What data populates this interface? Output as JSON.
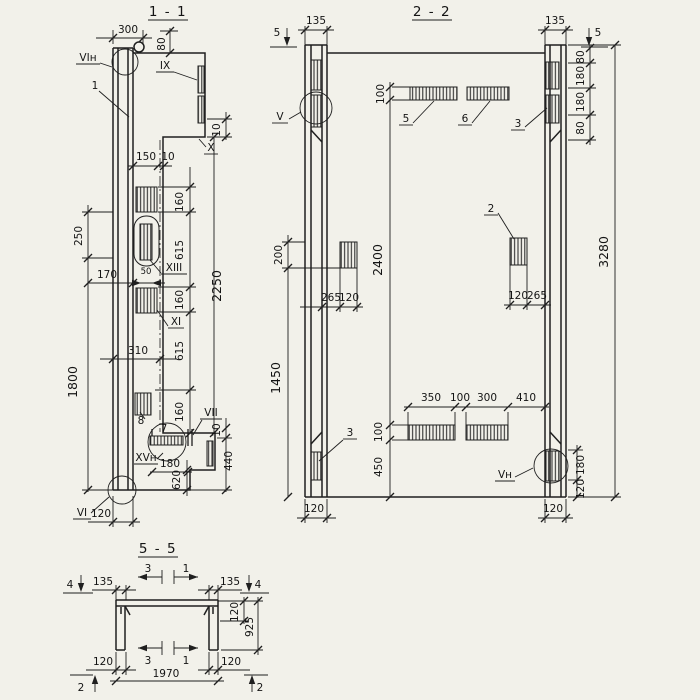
{
  "meta": {
    "paper_color": "#f2f1ea",
    "ink_color": "#1f1f1f",
    "drawing_type": "reinforced concrete element sections"
  },
  "s11": {
    "title": "1 - 1",
    "dim_300": "300",
    "dim_80": "80",
    "dim_10_top": "10",
    "dim_150": "150",
    "dim_10_web": "10",
    "dim_160_1": "160",
    "dim_615_1": "615",
    "dim_160_2": "160",
    "dim_615_2": "615",
    "dim_160_3": "160",
    "dim_2250": "2250",
    "dim_250": "250",
    "dim_170": "170",
    "dim_50": "50",
    "dim_310": "310",
    "dim_1800": "1800",
    "dim_10_bot": "10",
    "dim_440": "440",
    "dim_180": "180",
    "dim_620": "620",
    "dim_120": "120",
    "lbl_vi_n": "VIн",
    "lbl_1": "1",
    "lbl_ix": "IX",
    "lbl_x": "X",
    "lbl_xiii": "XIII",
    "lbl_xi": "XI",
    "lbl_vii": "VII",
    "lbl_7": "7",
    "lbl_8": "8",
    "lbl_xv_n": "XVн",
    "lbl_vi": "VI"
  },
  "s22": {
    "title": "2 - 2",
    "cut_5": "5",
    "dim_135_l": "135",
    "dim_135_r": "135",
    "dim_80_1": "80",
    "dim_180_1": "180",
    "dim_180_2": "180",
    "dim_80_2": "80",
    "dim_100_top": "100",
    "dim_200": "200",
    "dim_2400": "2400",
    "dim_1450": "1450",
    "dim_3280": "3280",
    "dim_265_l": "265",
    "dim_120_l": "120",
    "dim_120_r": "120",
    "dim_265_r": "265",
    "dim_350": "350",
    "dim_100_mid": "100",
    "dim_300": "300",
    "dim_410": "410",
    "dim_100_bot": "100",
    "dim_450": "450",
    "dim_180_br": "180",
    "dim_120_br": "120",
    "dim_120_bl": "120",
    "dim_120_bc": "120",
    "lbl_v": "V",
    "lbl_5": "5",
    "lbl_6": "6",
    "lbl_3_top": "3",
    "lbl_2": "2",
    "lbl_3_bot": "3",
    "lbl_v_n": "Vн"
  },
  "s55": {
    "title": "5 - 5",
    "cut_4": "4",
    "cut_3": "3",
    "cut_1": "1",
    "cut_2": "2",
    "dim_135_l": "135",
    "dim_135_r": "135",
    "dim_120_t": "120",
    "dim_925": "925",
    "dim_120_l": "120",
    "dim_120_r": "120",
    "dim_1970": "1970"
  }
}
